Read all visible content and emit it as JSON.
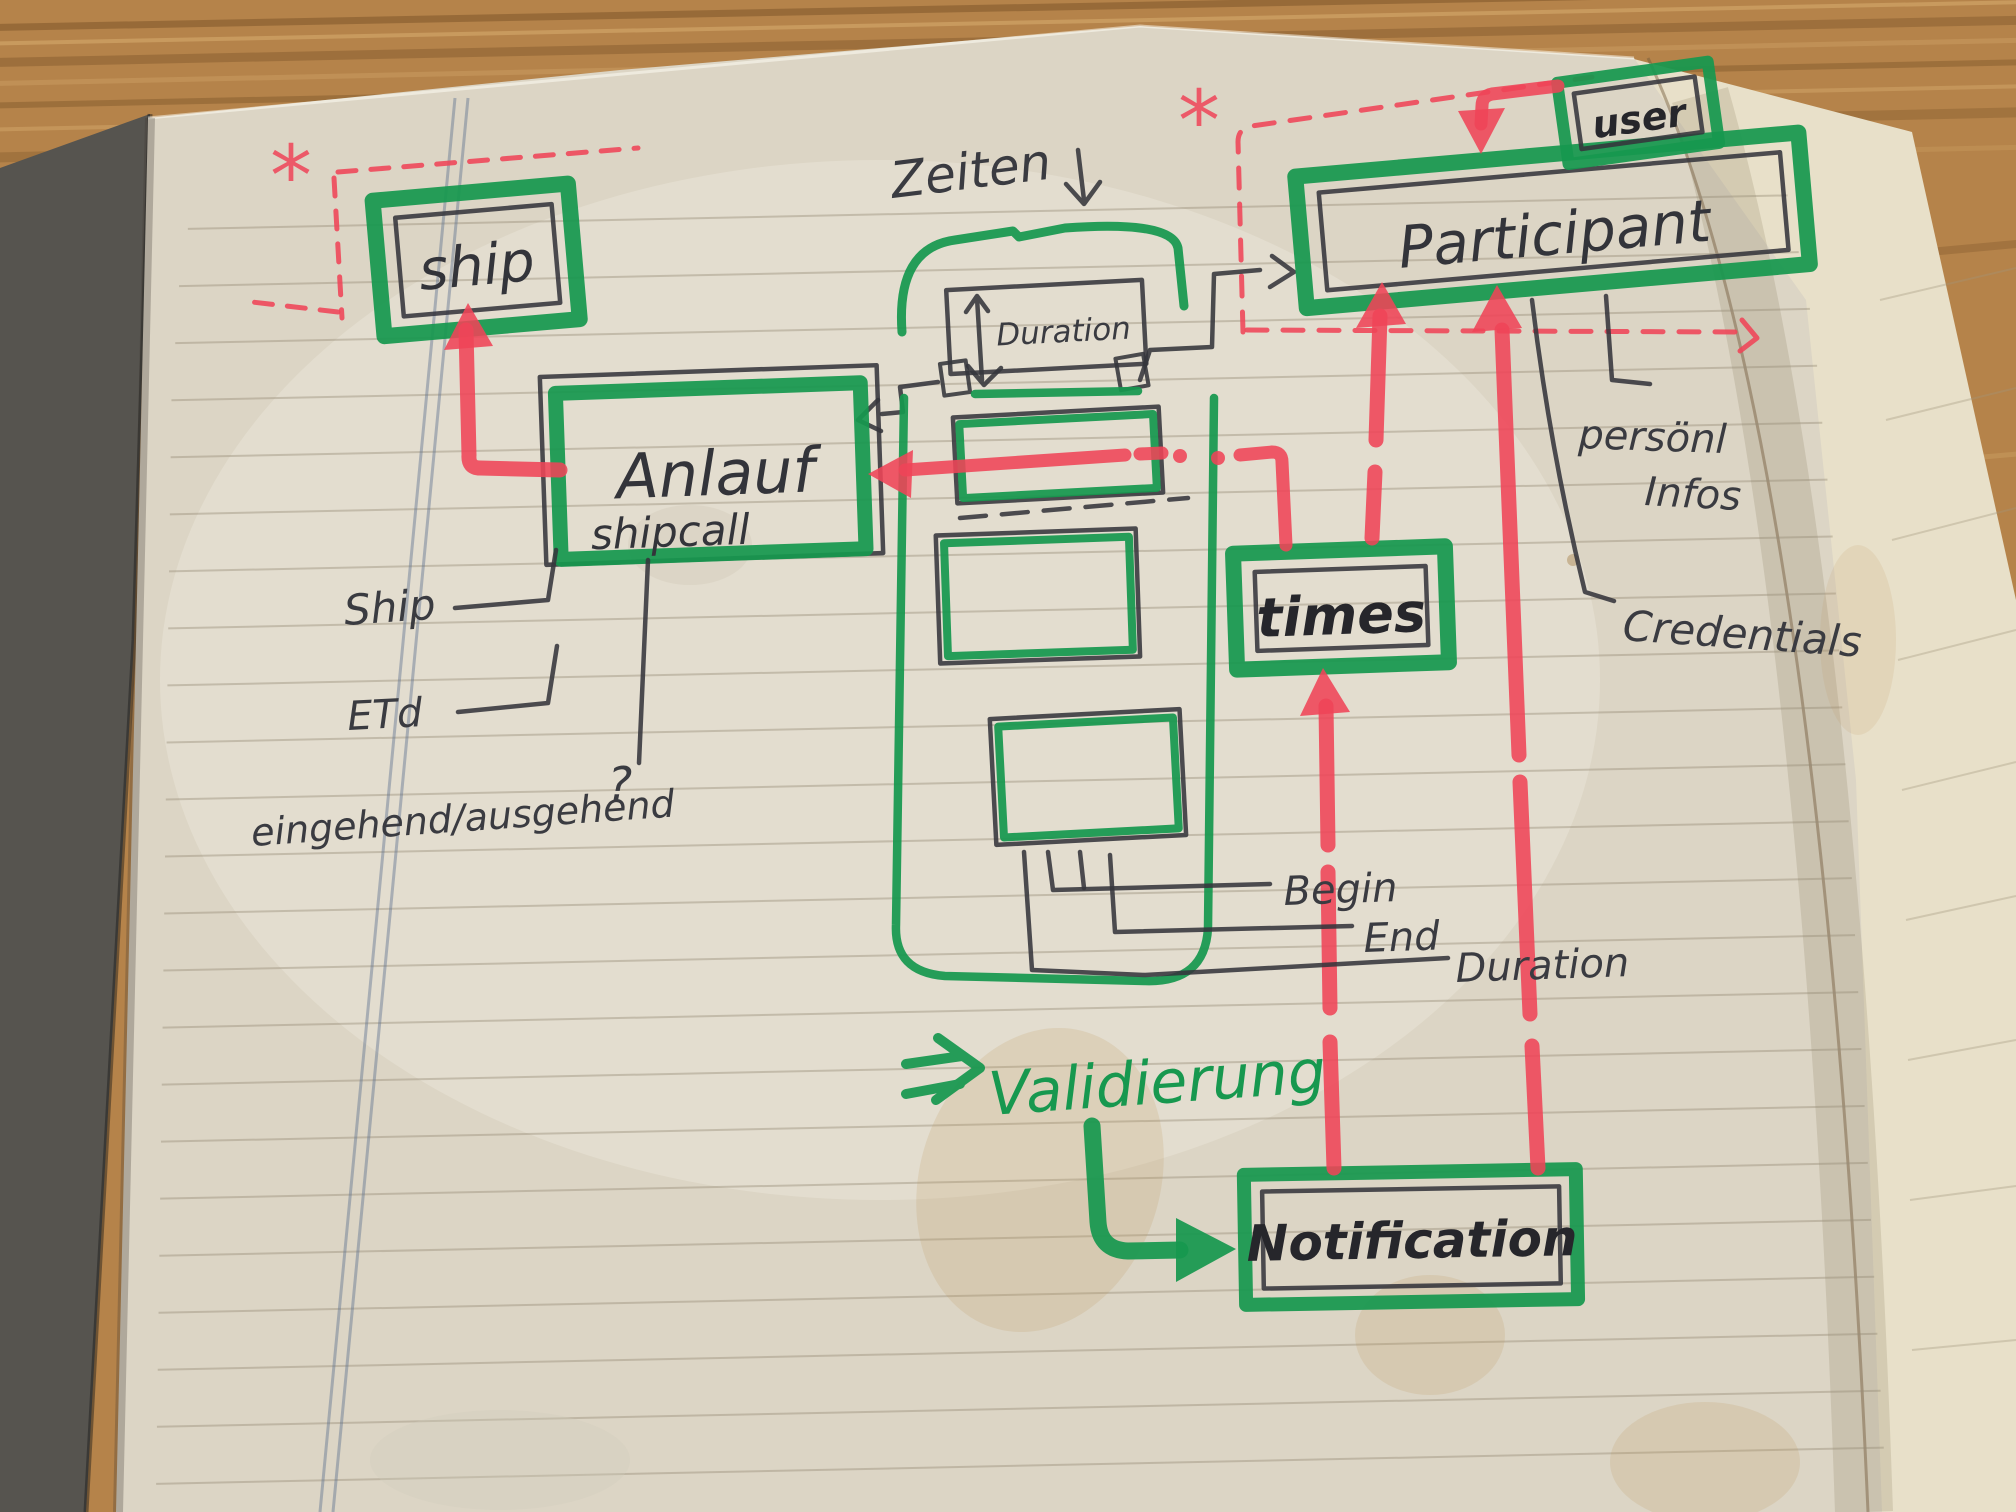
{
  "colors": {
    "marker_green": "#17984f",
    "marker_red": "#ef4458",
    "pen": "#35363c",
    "page": "#dcd5c5",
    "wood": "#b5834a"
  },
  "entities": {
    "ship": {
      "label": "ship",
      "cardinality": "*"
    },
    "anlauf": {
      "label": "Anlauf",
      "sublabel": "shipcall"
    },
    "duration_box": {
      "label": "Duration"
    },
    "participant": {
      "label": "Participant",
      "cardinality": "*"
    },
    "user": {
      "label": "user"
    },
    "times": {
      "label": "times"
    },
    "notification": {
      "label": "Notification"
    }
  },
  "attributes": {
    "ship_ref": "Ship",
    "eta": "ETd",
    "in_out": "eingehend/ausgehend",
    "in_out_question": "?",
    "begin": "Begin",
    "end": "End",
    "duration": "Duration",
    "personal_infos_line1": "persönl",
    "personal_infos_line2": "Infos",
    "credentials": "Credentials"
  },
  "annotations": {
    "zeiten": "Zeiten",
    "validierung": "Validierung"
  },
  "icons": {
    "zeiten_arrow": "down-arrow",
    "duration_arrow": "up-down-arrow",
    "validierung_arrow": "double-right-arrow",
    "notification_arrow": "elbow-right-arrow",
    "asterisk": "*"
  }
}
